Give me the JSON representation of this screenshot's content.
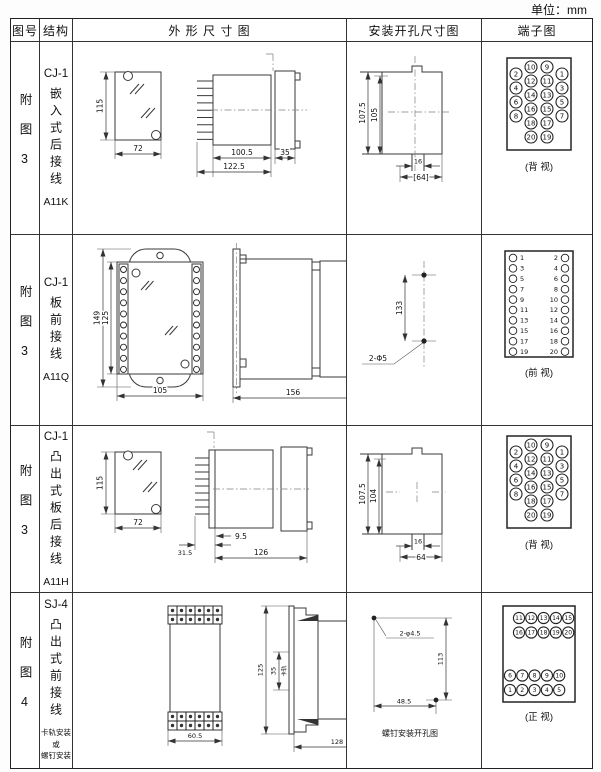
{
  "unit_label": "单位：mm",
  "columns": {
    "fig": "图号",
    "structure": "结构",
    "outline": "外 形 尺 寸 图",
    "mounting": "安装开孔尺寸图",
    "terminal": "端子图"
  },
  "rows": [
    {
      "figure_no": "附图3",
      "model": "CJ-1",
      "structure": "嵌入式后接线",
      "code": "A11K",
      "dims": {
        "front_height": "115",
        "front_width": "72",
        "body_length": "100.5",
        "overall_length": "122.5",
        "flange_depth": "35"
      },
      "mount": {
        "outer_height": "107.5",
        "inner_height": "105",
        "slot_width": "16",
        "overall_width": "[64]"
      },
      "terminal_view": "(背 视)"
    },
    {
      "figure_no": "附图3",
      "model": "CJ-1",
      "structure": "板前接线",
      "code": "A11Q",
      "dims": {
        "outer_height": "149",
        "inner_height": "125",
        "width": "105",
        "length": "156",
        "height": "115"
      },
      "mount": {
        "hole_spacing": "133",
        "hole_spec": "2-Φ5"
      },
      "terminal_view": "(前 视)"
    },
    {
      "figure_no": "附图3",
      "model": "CJ-1",
      "structure": "凸出式板后接线",
      "code": "A11H",
      "dims": {
        "front_height": "115",
        "front_width": "72",
        "pin_depth": "31.5",
        "offset": "9.5",
        "body_length": "126"
      },
      "mount": {
        "outer_height": "107.5",
        "inner_height": "104",
        "slot_width": "16",
        "overall_width": "64"
      },
      "terminal_view": "(背 视)"
    },
    {
      "figure_no": "附图4",
      "model": "SJ-4",
      "structure": "凸出式前接线",
      "note_lines": [
        "卡轨安装",
        "或",
        "螺钉安装"
      ],
      "dims": {
        "front_width": "60.5",
        "height": "125",
        "rail_width": "35",
        "rail_label": "卡轨",
        "length": "128"
      },
      "mount": {
        "hole_spec": "2-φ4.5",
        "v_spacing": "113",
        "h_spacing": "48.5",
        "caption": "螺钉安装开孔图"
      },
      "terminal_view": "(正 视)"
    }
  ],
  "terminals": {
    "back20": {
      "inner_left": [
        "10",
        "12",
        "14",
        "16",
        "18",
        "20"
      ],
      "inner_right": [
        "9",
        "11",
        "13",
        "15",
        "17",
        "19"
      ],
      "outer_left": [
        "2",
        "4",
        "6",
        "8"
      ],
      "outer_right": [
        "1",
        "3",
        "5",
        "7"
      ]
    },
    "front20_cols": {
      "left": [
        "1",
        "3",
        "5",
        "7",
        "9",
        "11",
        "13",
        "15",
        "17",
        "19"
      ],
      "right": [
        "2",
        "4",
        "6",
        "8",
        "10",
        "12",
        "14",
        "16",
        "18",
        "20"
      ]
    },
    "front20_rows": {
      "top1": [
        "11",
        "12",
        "13",
        "14",
        "15"
      ],
      "top2": [
        "16",
        "17",
        "18",
        "19",
        "20"
      ],
      "bottom1": [
        "6",
        "7",
        "8",
        "9",
        "10"
      ],
      "bottom2": [
        "1",
        "2",
        "3",
        "4",
        "5"
      ]
    }
  }
}
